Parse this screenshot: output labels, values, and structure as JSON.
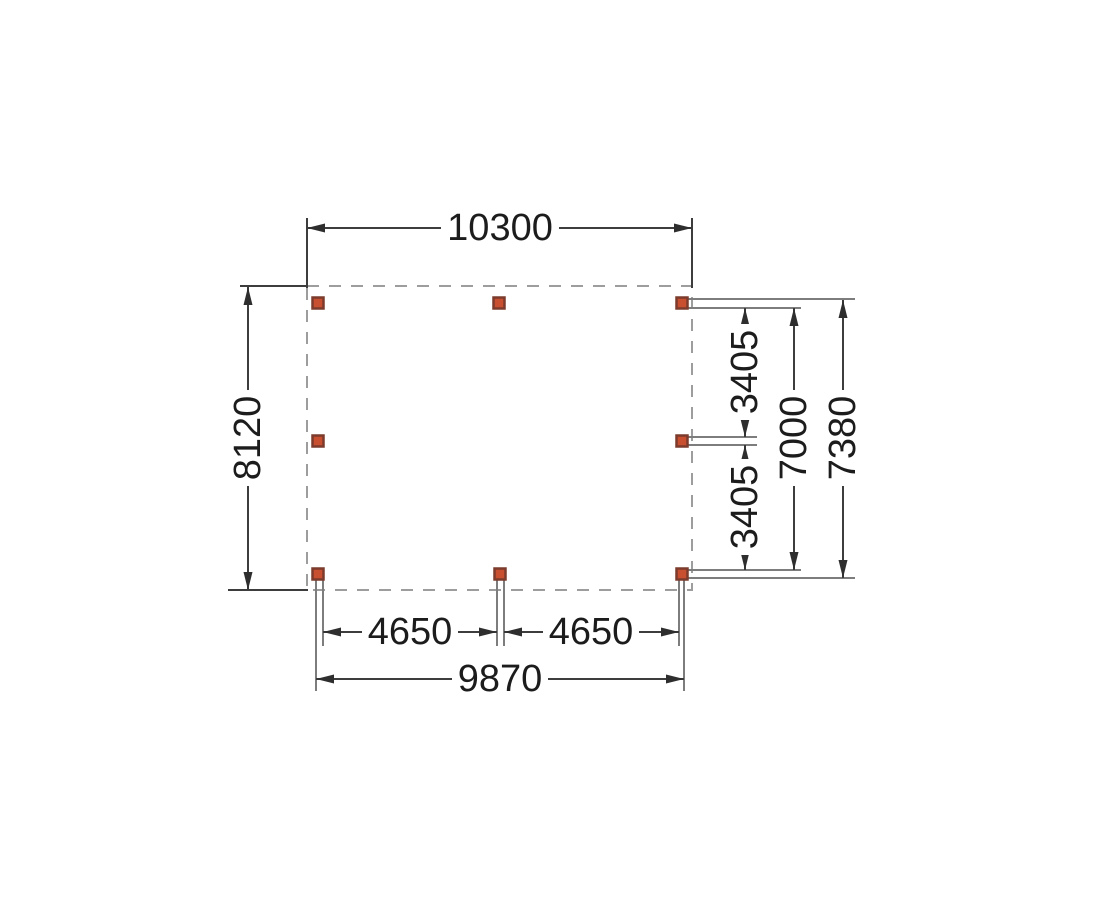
{
  "drawing": {
    "kind": "floor-plan-dimension-drawing",
    "labels": {
      "width_total": "10300",
      "depth_total": "8120",
      "bay_upper_right": "3405",
      "bay_lower_right": "3405",
      "depth_posts": "7000",
      "depth_overall_right": "7380",
      "bay_bottom_left": "4650",
      "bay_bottom_right": "4650",
      "width_posts": "9870"
    },
    "posts": {
      "count": 8
    },
    "colors": {
      "post_fill": "#c84f30",
      "post_border": "#7c3b2c",
      "outline_dash": "#9d9d9d",
      "dimension_line": "#3d3d3d",
      "beam_line": "#7d7d7d",
      "text": "#1c1c1c",
      "background": "#ffffff"
    }
  }
}
